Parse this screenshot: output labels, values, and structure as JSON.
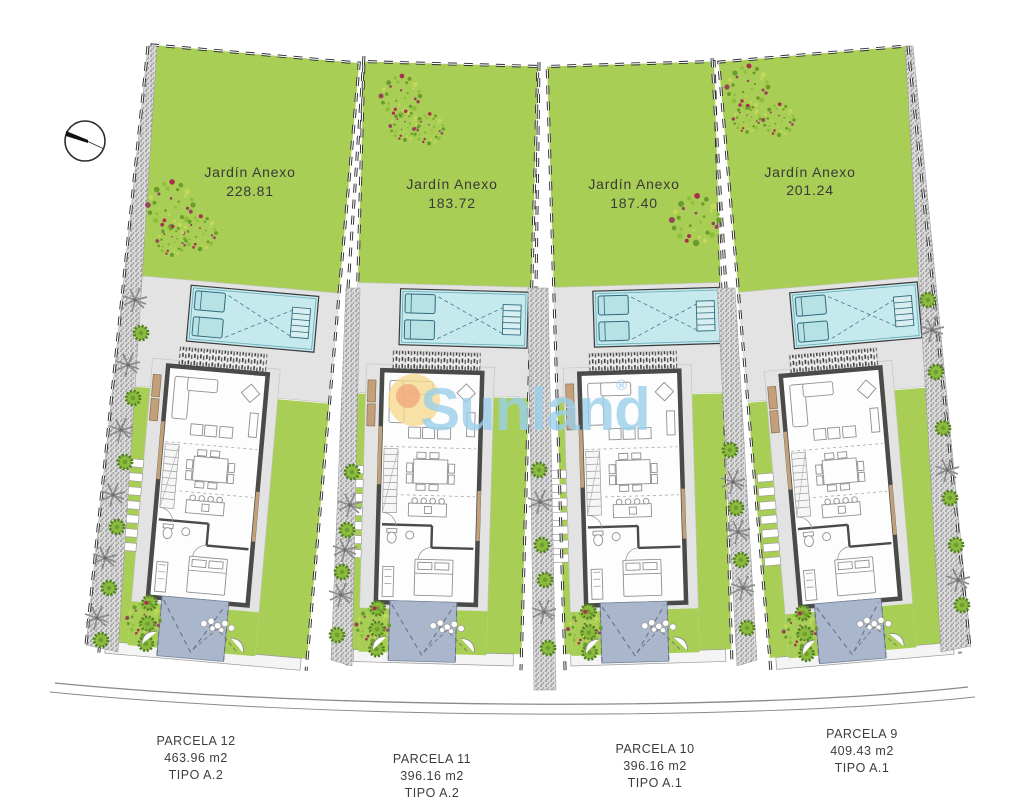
{
  "plan": {
    "watermark": {
      "brand": "Sunland",
      "registered": "®"
    },
    "compass": "north-compass",
    "plots": [
      {
        "id": "parcela-12",
        "garden_label": "Jardín Anexo",
        "garden_area": "228.81",
        "parcel_name": "PARCELA 12",
        "parcel_area": "463.96 m2",
        "parcel_type": "TIPO A.2"
      },
      {
        "id": "parcela-11",
        "garden_label": "Jardín Anexo",
        "garden_area": "183.72",
        "parcel_name": "PARCELA 11",
        "parcel_area": "396.16 m2",
        "parcel_type": "TIPO A.2"
      },
      {
        "id": "parcela-10",
        "garden_label": "Jardín Anexo",
        "garden_area": "187.40",
        "parcel_name": "PARCELA 10",
        "parcel_area": "396.16 m2",
        "parcel_type": "TIPO A.1"
      },
      {
        "id": "parcela-9",
        "garden_label": "Jardín Anexo",
        "garden_area": "201.24",
        "parcel_name": "PARCELA 9",
        "parcel_area": "409.43 m2",
        "parcel_type": "TIPO A.1"
      }
    ]
  },
  "colors": {
    "lawn": "#a8ce55",
    "terrace": "#e3e3e3",
    "pool": "#c6e9ed",
    "driveway": "#a9b6cb",
    "watermark": "#9bd0ea",
    "sun": "#f6d88d"
  }
}
